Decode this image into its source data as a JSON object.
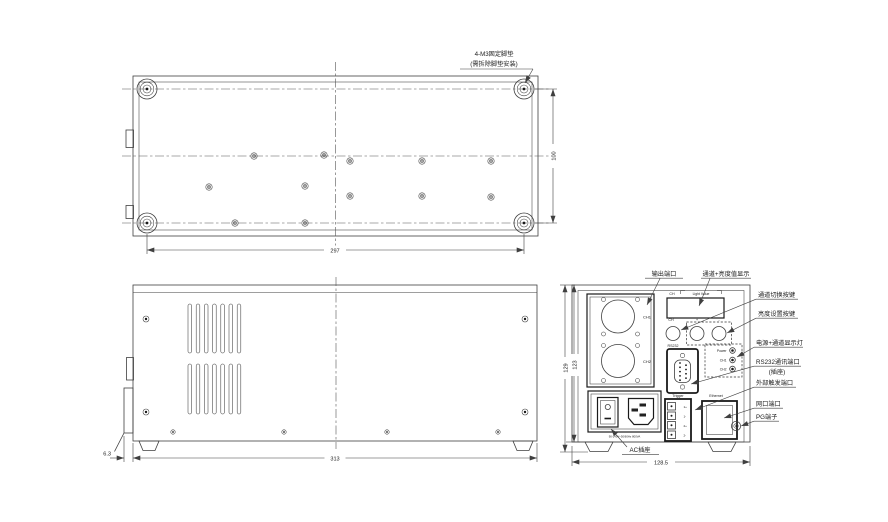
{
  "colors": {
    "line": "#3f3f3f",
    "heavy": "#1a1a1a",
    "background": "#ffffff"
  },
  "note": {
    "line1": "4-M3固定脚垫",
    "line2": "(需拆除脚垫安装)"
  },
  "dimensions": {
    "top_width": "297",
    "top_depth": "100",
    "side_length": "313",
    "side_offset": "6.3",
    "rear_height_total": "129",
    "rear_height_body": "123",
    "rear_width": "128.5"
  },
  "rear": {
    "callouts": {
      "output_port": "输出端口",
      "display": "通道+亮度值显示",
      "channel_switch": "通道切换按键",
      "brightness_set": "亮度设置按键",
      "indicator": "电源+通道显示灯",
      "rs232_line1": "RS232通讯端口",
      "rs232_line2": "(插座)",
      "trigger": "外部触发端口",
      "ethernet": "网口端口",
      "pg": "PG端子",
      "ac": "AC插座"
    },
    "panel": {
      "display_ch": "CH",
      "display_title": "Light Value",
      "ch1": "CH1",
      "ch2": "CH2",
      "btn_ch": "CH",
      "btn_plus": "+",
      "btn_minus": "-",
      "rs232": "RS232",
      "led_power": "Power",
      "led_ch1": "CH1",
      "led_ch2": "CH2",
      "trigger": "Trigger",
      "ethernet": "Ethernet",
      "trigger_pins": [
        "1+",
        "1-",
        "2+",
        "2-"
      ],
      "ac_rating": "90-240V~50/60Hz 800VA"
    }
  }
}
